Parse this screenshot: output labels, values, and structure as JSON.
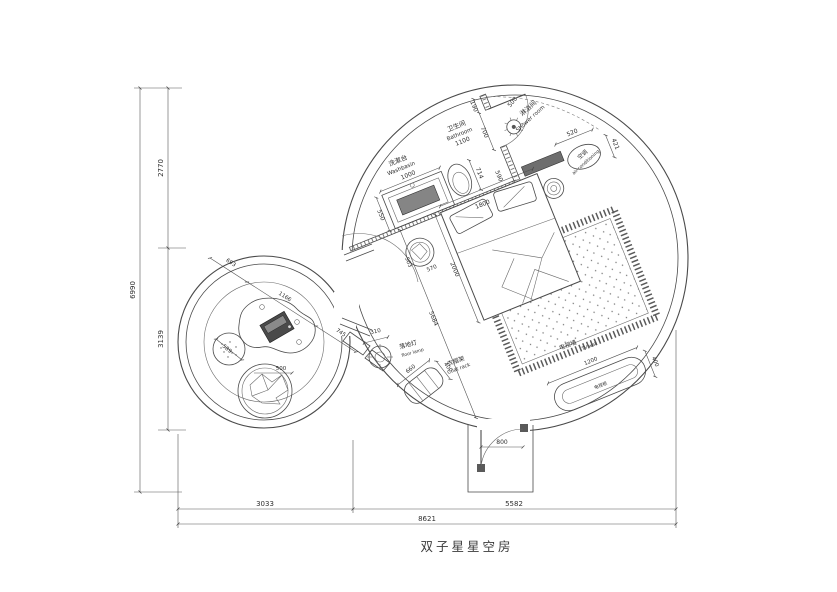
{
  "title": "双子星星空房",
  "outer_dims": {
    "left_total": "6990",
    "left_top": "2770",
    "left_bottom": "3139",
    "bottom_left": "3033",
    "bottom_right": "5582",
    "bottom_total": "8621"
  },
  "bathroom": {
    "washbasin_cn": "洗漱台",
    "washbasin_en": "Washbasin",
    "washbasin_width": "1000",
    "washbasin_depth": "550",
    "bathroom_cn": "卫生间",
    "bathroom_en": "Bathroom",
    "bathroom_width": "1100",
    "toilet_width": "714",
    "door_side": "190",
    "door_width": "700",
    "door_clear": "500",
    "niche": "590"
  },
  "shower": {
    "cn": "淋浴间",
    "en": "Shower room"
  },
  "ac": {
    "cn": "空调",
    "en": "air-conditioning",
    "width": "520",
    "depth": "421"
  },
  "bedroom": {
    "bed_width": "1800",
    "bed_length": "2000",
    "room_length": "5684",
    "side_table_d1": "503",
    "side_table_d2": "570"
  },
  "lamp": {
    "cn": "落地灯",
    "en": "floor lamp",
    "dia": "310"
  },
  "coat_rack": {
    "cn": "衣帽架",
    "en": "Coat rack",
    "length": "660",
    "depth": "400"
  },
  "tv": {
    "wall_cn": "电视墙",
    "wall_en": "TV wall",
    "cabinet_cn": "电视柜",
    "length": "1200",
    "depth": "400"
  },
  "entry": {
    "door_width": "800"
  },
  "lounge": {
    "dim_a": "693",
    "dim_b": "1166",
    "dim_c": "745",
    "pouf_dia": "589",
    "chair_dia": "500"
  }
}
